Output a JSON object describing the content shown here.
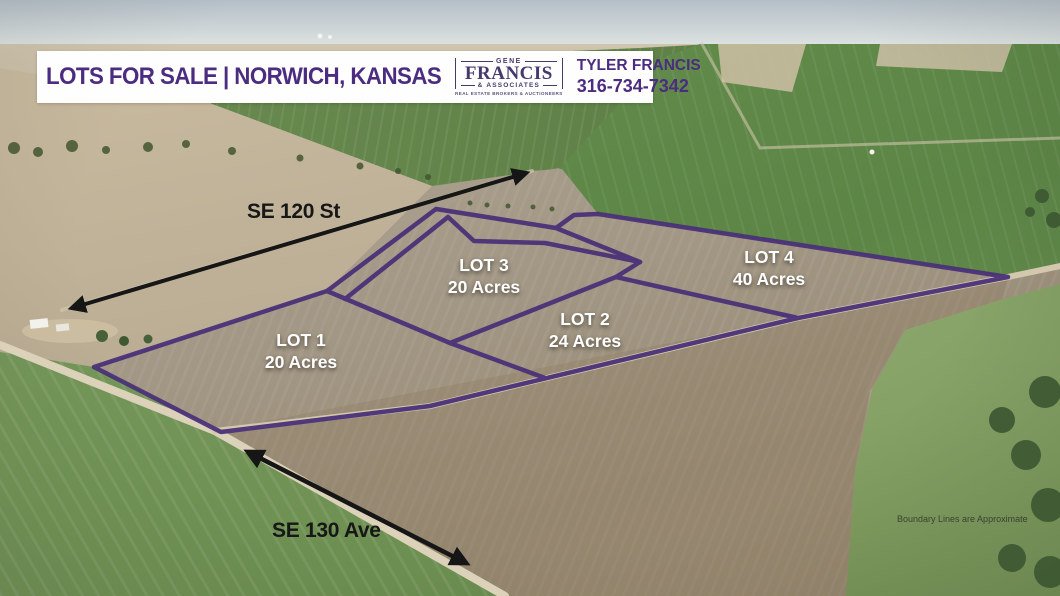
{
  "banner": {
    "title": "LOTS FOR SALE | NORWICH, KANSAS",
    "logo": {
      "top": "GENE",
      "name": "FRANCIS",
      "suffix": "& ASSOCIATES",
      "tagline": "REAL ESTATE BROKERS & AUCTIONEERS"
    },
    "agent": {
      "name": "TYLER FRANCIS",
      "phone": "316-734-7342"
    }
  },
  "map": {
    "road_labels": [
      {
        "label": "SE 120 St"
      },
      {
        "label": "SE 130 Ave"
      }
    ],
    "lots": [
      {
        "name": "LOT 1",
        "size": "20 Acres"
      },
      {
        "name": "LOT 2",
        "size": "24 Acres"
      },
      {
        "name": "LOT 3",
        "size": "20 Acres"
      },
      {
        "name": "LOT 4",
        "size": "40 Acres"
      }
    ],
    "disclaimer": "Boundary Lines are Approximate",
    "boundary_color": "#4a3178",
    "arrow_color": "#161616"
  }
}
